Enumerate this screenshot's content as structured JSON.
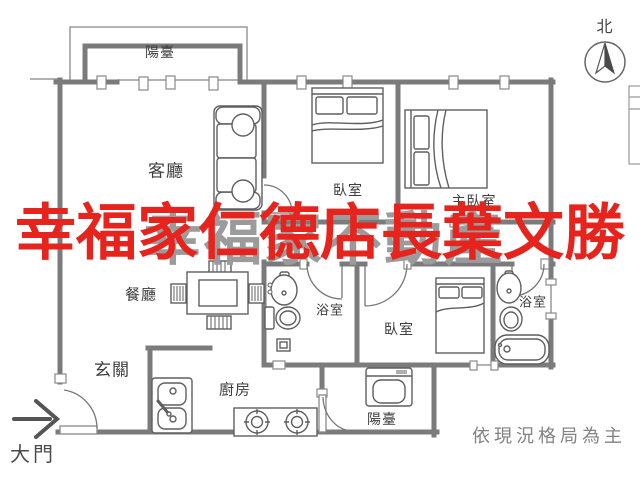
{
  "title": "apartment-floor-plan",
  "colors": {
    "wall": "#7b7b7b",
    "thin_line": "#999999",
    "furniture_line": "#5f5f5f",
    "door_arc": "#777777",
    "label": "#3d3d3d",
    "watermark_red": "#e6231c",
    "watermark_gray": "#9b9b9b",
    "disclaimer": "#828282"
  },
  "watermarks": {
    "red_text": "幸福家仁德店長葉文勝",
    "gray_text": "幸福家不動產"
  },
  "compass": {
    "north_label": "北"
  },
  "rooms": [
    {
      "id": "balcony-top",
      "label": "陽臺"
    },
    {
      "id": "living-room",
      "label": "客廳"
    },
    {
      "id": "bedroom-1",
      "label": "臥室"
    },
    {
      "id": "master-bedroom",
      "label": "主臥室"
    },
    {
      "id": "dining-room",
      "label": "餐廳"
    },
    {
      "id": "bathroom-1",
      "label": "浴室"
    },
    {
      "id": "bedroom-2",
      "label": "臥室"
    },
    {
      "id": "bathroom-2",
      "label": "浴室"
    },
    {
      "id": "foyer",
      "label": "玄關"
    },
    {
      "id": "kitchen",
      "label": "廚房"
    },
    {
      "id": "balcony-bottom",
      "label": "陽臺"
    }
  ],
  "annotations": {
    "main_door": "大門",
    "disclaimer": "依現況格局為主"
  }
}
